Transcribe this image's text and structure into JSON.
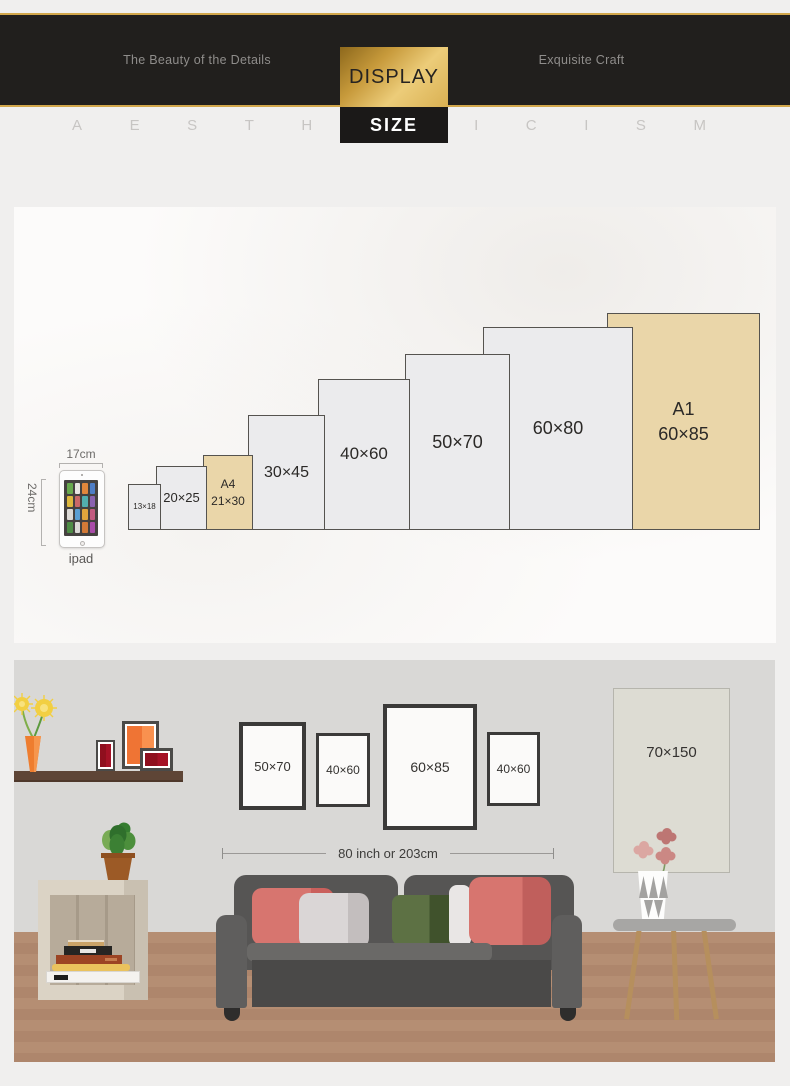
{
  "header": {
    "left_tagline": "The Beauty of the Details",
    "right_tagline": "Exquisite Craft",
    "display_label": "DISPLAY",
    "size_label": "SIZE",
    "watermark_letters": [
      "A",
      "E",
      "S",
      "T",
      "H",
      "E",
      "T",
      "I",
      "C",
      "I",
      "S",
      "M"
    ],
    "colors": {
      "band": "#211f1d",
      "gold_line": "#d2a74b",
      "gold_gradient_from": "#8d681c",
      "gold_gradient_to": "#eccc79"
    }
  },
  "size_chart": {
    "ipad": {
      "width_label": "17cm",
      "height_label": "24cm",
      "caption": "ipad"
    },
    "default_color": "#ebebed",
    "highlight_color": "#ead6a9",
    "sizes": [
      {
        "lines": [
          "13×18"
        ],
        "width_cm": 13,
        "height_cm": 18,
        "highlight": false
      },
      {
        "lines": [
          "20×25"
        ],
        "width_cm": 20,
        "height_cm": 25,
        "highlight": false
      },
      {
        "lines": [
          "A4",
          "21×30"
        ],
        "width_cm": 21,
        "height_cm": 30,
        "highlight": true
      },
      {
        "lines": [
          "30×45"
        ],
        "width_cm": 30,
        "height_cm": 45,
        "highlight": false
      },
      {
        "lines": [
          "40×60"
        ],
        "width_cm": 40,
        "height_cm": 60,
        "highlight": false
      },
      {
        "lines": [
          "50×70"
        ],
        "width_cm": 50,
        "height_cm": 70,
        "highlight": false
      },
      {
        "lines": [
          "60×80"
        ],
        "width_cm": 60,
        "height_cm": 80,
        "highlight": false
      },
      {
        "lines": [
          "A1",
          "60×85"
        ],
        "width_cm": 60,
        "height_cm": 85,
        "highlight": true
      }
    ]
  },
  "room": {
    "wall_posters": [
      {
        "label": "50×70"
      },
      {
        "label": "40×60"
      },
      {
        "label": "60×85"
      },
      {
        "label": "40×60"
      },
      {
        "label": "70×150"
      }
    ],
    "sofa_width_label": "80 inch or 203cm"
  }
}
